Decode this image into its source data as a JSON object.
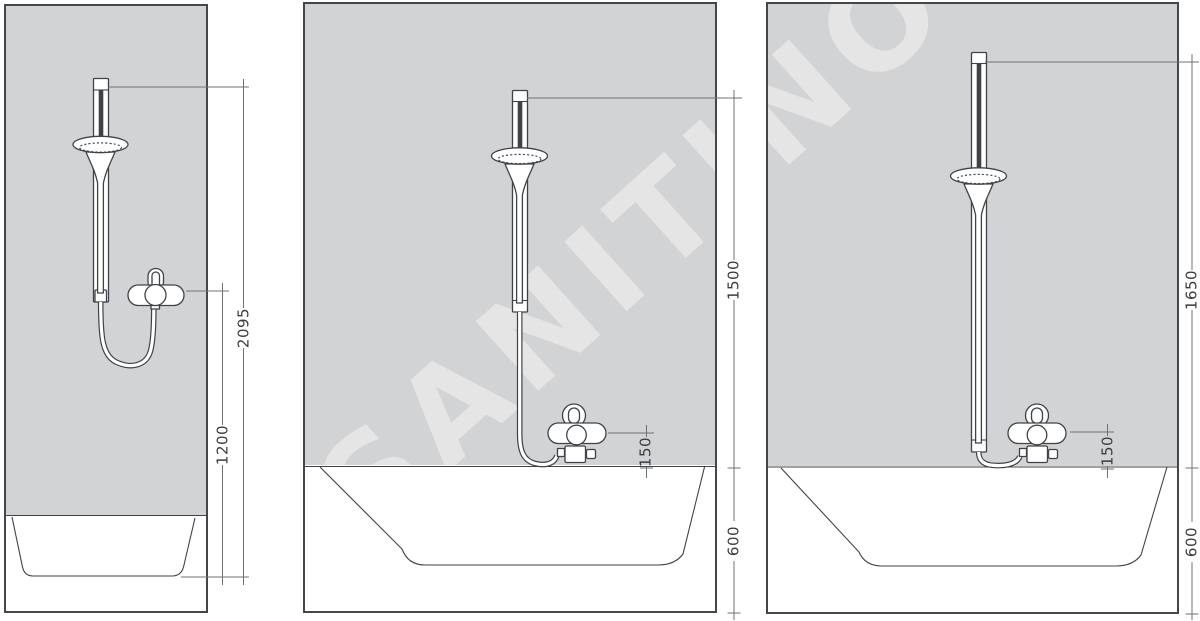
{
  "watermark": "SANITINO",
  "colors": {
    "wall": "#d2d3d5",
    "drawing_line": "#3f4347",
    "dimension_line": "#6f7276",
    "dimension_text": "#3a3d40",
    "background": "#ffffff"
  },
  "panels": [
    {
      "dimensions": {
        "total_height": "2095",
        "mixer_height": "1200"
      }
    },
    {
      "dimensions": {
        "rail_height": "1500",
        "mixer_offset": "150",
        "tub_height": "600"
      }
    },
    {
      "dimensions": {
        "rail_height": "1650",
        "mixer_offset": "150",
        "tub_height": "600"
      }
    }
  ]
}
